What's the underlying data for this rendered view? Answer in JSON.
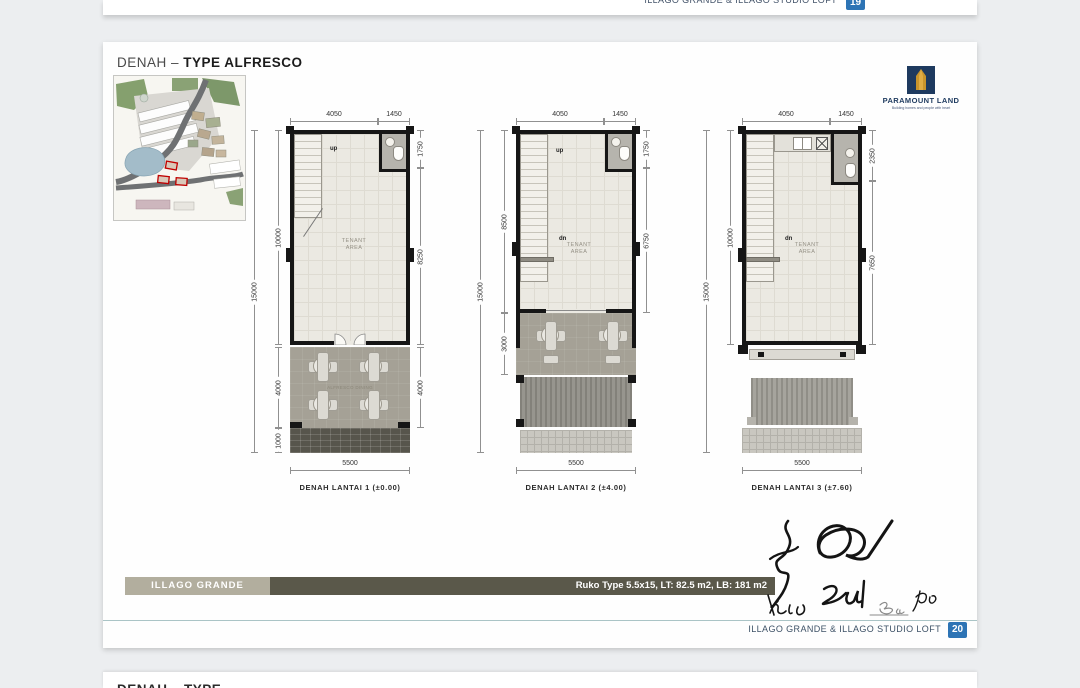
{
  "prev_page": {
    "footer_text": "ILLAGO GRANDE & ILLAGO STUDIO LOFT",
    "page_badge": "19"
  },
  "header": {
    "title_prefix": "DENAH –",
    "title_bold": "TYPE ALFRESCO"
  },
  "logo": {
    "brand": "PARAMOUNT LAND",
    "tagline": "Building homes and people with heart"
  },
  "plans": [
    {
      "label": "DENAH LANTAI 1 (±0.00)",
      "top_dims": [
        "4050",
        "1450"
      ],
      "right_dims": [
        "1750",
        "8250",
        "4000"
      ],
      "left_dims": [
        "10000",
        "4000",
        "1000",
        "15000"
      ],
      "bottom_dim": "5500",
      "stair_up": "up",
      "area_label": "TENANT\nAREA",
      "patio_label": "ALFRESCO DINING"
    },
    {
      "label": "DENAH LANTAI 2 (±4.00)",
      "top_dims": [
        "4050",
        "1450"
      ],
      "right_dims": [
        "1750",
        "6750"
      ],
      "left_dims": [
        "8500",
        "3000",
        "15000"
      ],
      "bottom_dim": "5500",
      "stair_up": "up",
      "stair_dn": "dn",
      "area_label": "TENANT\nAREA"
    },
    {
      "label": "DENAH LANTAI 3 (±7.60)",
      "top_dims": [
        "4050",
        "1450"
      ],
      "right_dims": [
        "2350",
        "7650"
      ],
      "left_dims": [
        "10000",
        "15000"
      ],
      "bottom_dim": "5500",
      "stair_dn": "dn",
      "area_label": "TENANT\nAREA"
    }
  ],
  "spec_bar": {
    "project_label": "ILLAGO GRANDE",
    "spec_text": "Ruko Type 5.5x15,   LT: 82.5 m2,  LB: 181  m2"
  },
  "footer": {
    "text": "ILLAGO GRANDE & ILLAGO STUDIO LOFT",
    "page_badge": "20"
  },
  "next_page": {
    "title_partial": "DENAH – TYPE"
  },
  "colors": {
    "accent_blue": "#2d74b5",
    "brand_navy": "#1e3a5f",
    "brand_gold": "#c9952c",
    "bar_olive_light": "#b2ae9e",
    "bar_olive_dark": "#5a584a"
  }
}
